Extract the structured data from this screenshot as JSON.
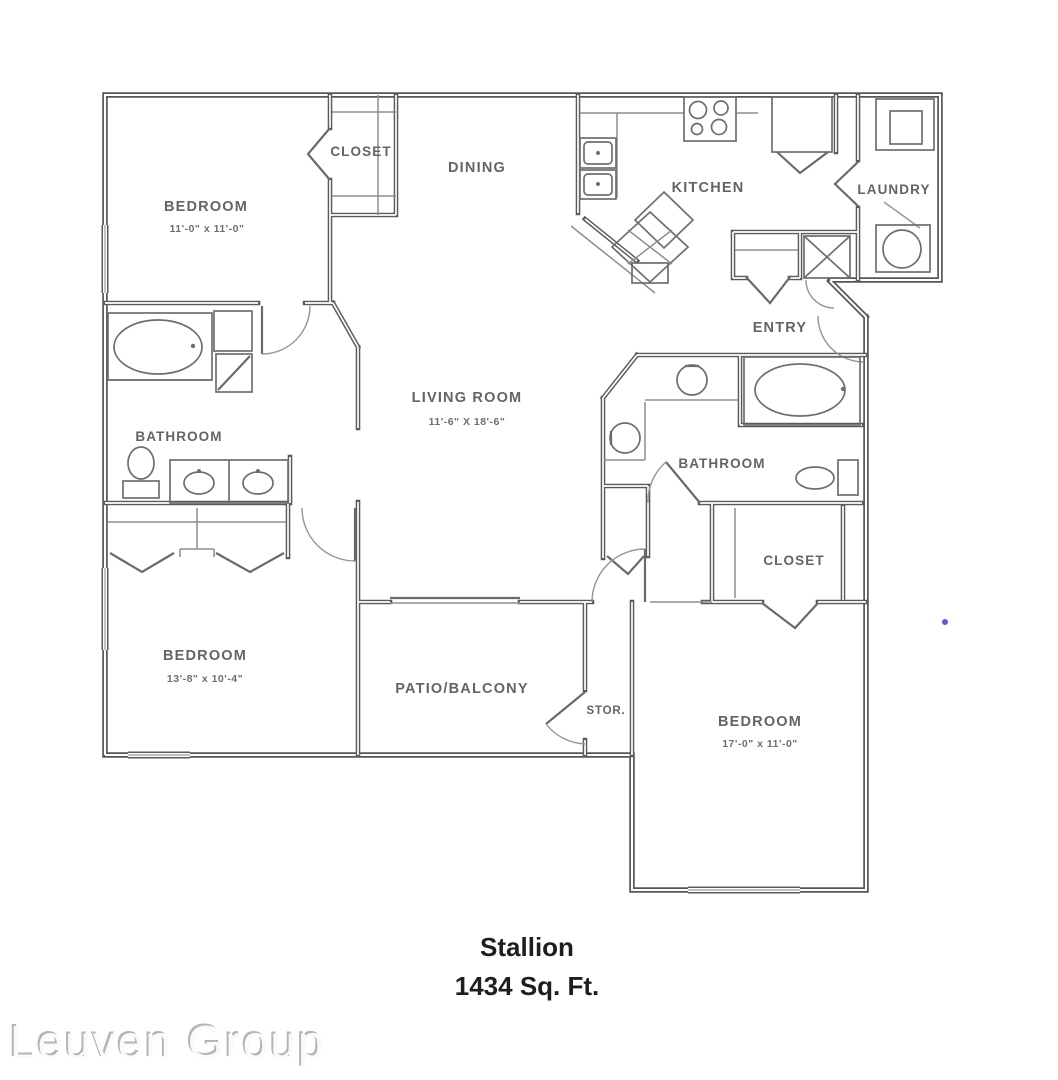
{
  "floor_plan": {
    "name": "Stallion",
    "area": "1434 Sq. Ft.",
    "watermark": "Leuven Group",
    "rooms": {
      "closet_top_left": {
        "label": "CLOSET"
      },
      "bedroom_top_left": {
        "label": "BEDROOM",
        "dims": "11'-0\" x 11'-0\""
      },
      "dining": {
        "label": "DINING"
      },
      "kitchen": {
        "label": "KITCHEN"
      },
      "laundry": {
        "label": "LAUNDRY"
      },
      "entry": {
        "label": "ENTRY"
      },
      "bathroom_left": {
        "label": "BATHROOM"
      },
      "living_room": {
        "label": "LIVING ROOM",
        "dims": "11'-6\" X 18'-6\""
      },
      "bathroom_right": {
        "label": "BATHROOM"
      },
      "closet_right": {
        "label": "CLOSET"
      },
      "bedroom_bottom_left": {
        "label": "BEDROOM",
        "dims": "13'-8\" x 10'-4\""
      },
      "patio_balcony": {
        "label": "PATIO/BALCONY"
      },
      "storage": {
        "label": "STOR."
      },
      "bedroom_bottom_right": {
        "label": "BEDROOM",
        "dims": "17'-0\" x 11'-0\""
      }
    },
    "colors": {
      "wall": "#565656",
      "label": "#646464",
      "title": "#1e1e1e",
      "watermark": "#c4c4c4",
      "accent_dot": "#4b48c4"
    }
  }
}
